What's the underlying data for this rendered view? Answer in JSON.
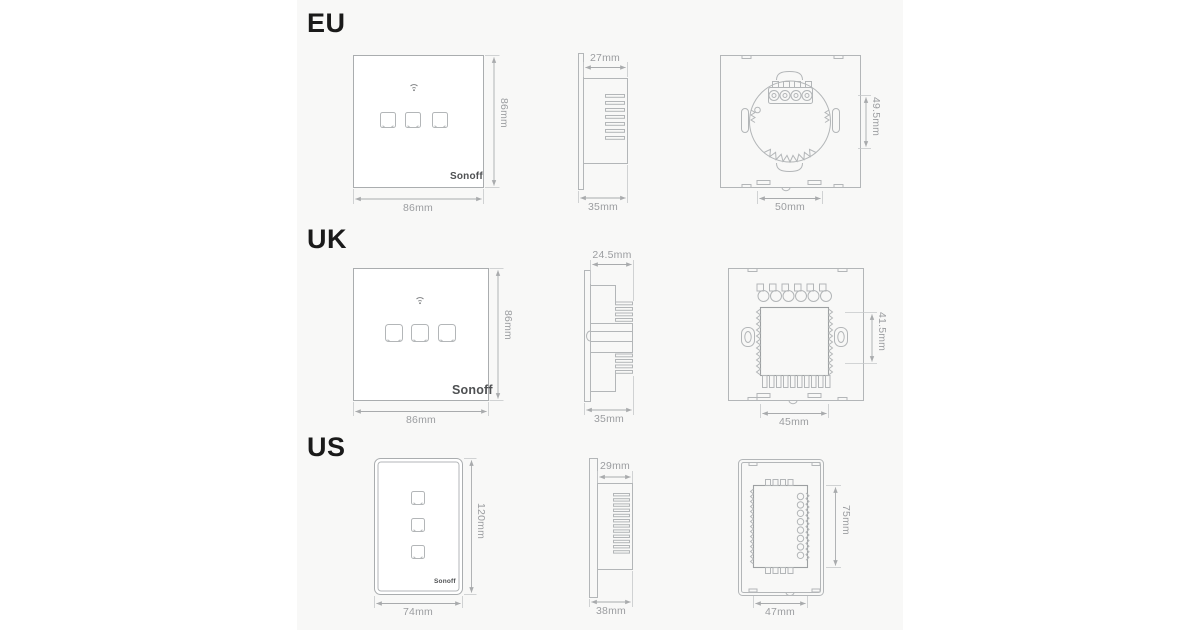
{
  "meta": {
    "brand": "Sonoff"
  },
  "colors": {
    "background": "#ffffff",
    "panel_background": "#f8f8f7",
    "line": "#b3b6b8",
    "dim_text": "#9b9da0",
    "heading_text": "#1a1a1a",
    "logo_text": "#4e5052"
  },
  "rows": [
    {
      "label": "EU",
      "front": {
        "width": "86mm",
        "height": "86mm"
      },
      "side": {
        "depth_body": "27mm",
        "depth_total": "35mm"
      },
      "back": {
        "width": "50mm",
        "height": "49.5mm"
      }
    },
    {
      "label": "UK",
      "front": {
        "width": "86mm",
        "height": "86mm"
      },
      "side": {
        "depth_body": "24.5mm",
        "depth_total": "35mm"
      },
      "back": {
        "width": "45mm",
        "height": "41.5mm"
      }
    },
    {
      "label": "US",
      "front": {
        "width": "74mm",
        "height": "120mm"
      },
      "side": {
        "depth_body": "29mm",
        "depth_total": "38mm"
      },
      "back": {
        "width": "47mm",
        "height": "75mm"
      }
    }
  ]
}
